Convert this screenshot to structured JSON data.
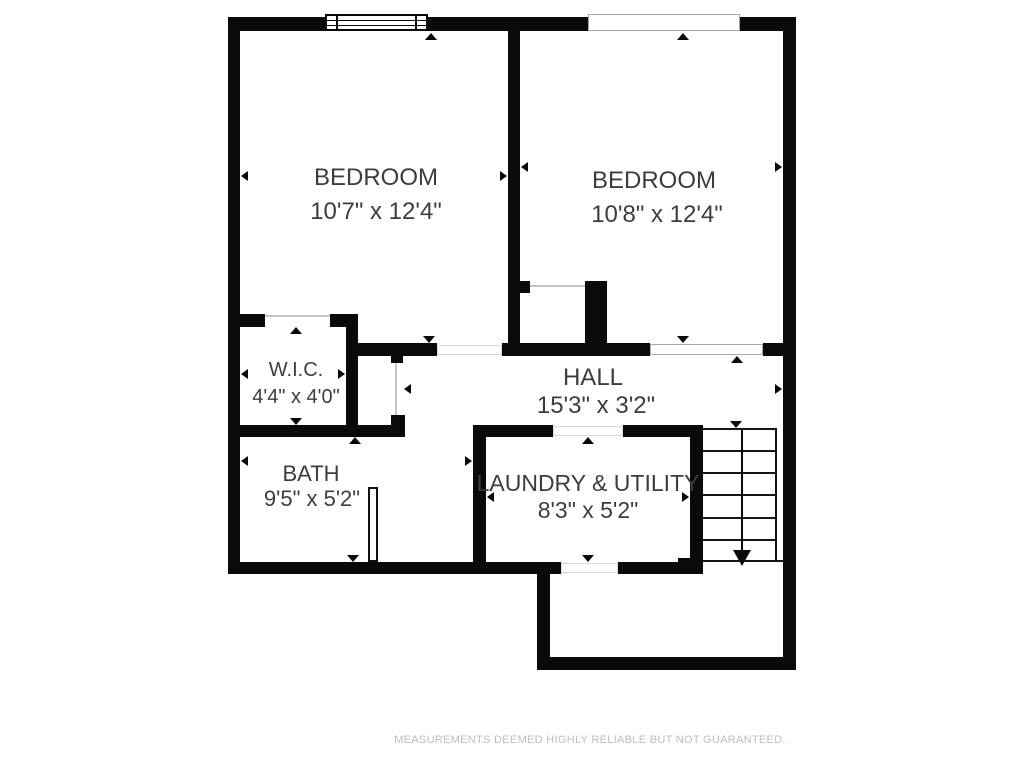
{
  "floor_plan": {
    "rooms": [
      {
        "name": "BEDROOM",
        "dims": "10'7\" x 12'4\""
      },
      {
        "name": "BEDROOM",
        "dims": "10'8\" x 12'4\""
      },
      {
        "name": "W.I.C.",
        "dims": "4'4\" x 4'0\""
      },
      {
        "name": "HALL",
        "dims": "15'3\" x 3'2\""
      },
      {
        "name": "BATH",
        "dims": "9'5\" x 5'2\""
      },
      {
        "name": "LAUNDRY & UTILITY",
        "dims": "8'3\" x 5'2\""
      }
    ],
    "symbols": {
      "window": "window-symbol",
      "wall_openings": [
        "exterior-opening-top-right",
        "hall-bedroom2-opening"
      ],
      "stairs_direction": "down-arrow"
    },
    "colors": {
      "wall": "#0a0a0a",
      "room_text": "#3d3d3d",
      "door_line": "#c4c4c4",
      "opening_border": "#a8a8a8",
      "footer_text": "#bdbdbd",
      "background": "#ffffff"
    },
    "footer_disclaimer": "MEASUREMENTS DEEMED HIGHLY RELIABLE BUT NOT GUARANTEED."
  }
}
